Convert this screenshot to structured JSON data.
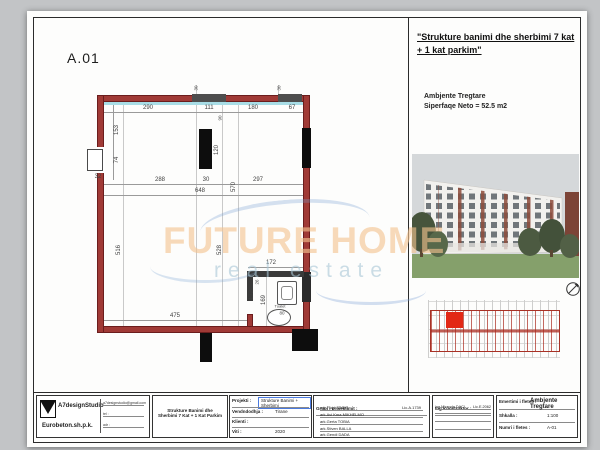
{
  "plan": {
    "label": "A.01",
    "tualet": "Tualet",
    "dims": {
      "d290": "290",
      "d111": "111",
      "d180": "180",
      "d67": "67",
      "d153": "153",
      "d74": "74",
      "d32": "32",
      "d288": "288",
      "d30": "30",
      "d297": "297",
      "d648": "648",
      "d570": "570",
      "d120": "120",
      "d90": "90",
      "d516": "516",
      "d528": "528",
      "d475": "475",
      "t172a": "172",
      "t172b": "172",
      "d169": "169",
      "d26": "26",
      "d80": "80",
      "tiny30a": "30",
      "tiny30b": "30"
    }
  },
  "watermark": {
    "line1": "FUTURE HOME",
    "line2": "real estate"
  },
  "header": {
    "title_line1": "\"Strukture banimi dhe sherbimi 7 kat",
    "title_line2": "+ 1 kat parkim\"",
    "unit": "Ambjente Tregtare",
    "area": "Siperfaqe Neto = 52.5 m2"
  },
  "titleblock": {
    "company": "A7designStudio",
    "company2": "Eurobeton.sh.p.k.",
    "contact": [
      "a7designstudio@gmail.com",
      "tel :",
      "adr :"
    ],
    "project_title_l1": "Strukture Banimi dhe",
    "project_title_l2": "Sherbimi 7 Kat + 1 Kat Parkim",
    "fields": [
      {
        "label": "Projekti :",
        "value": "Strukture Banimi + Sherbimi"
      },
      {
        "label": "Vendndodhja :",
        "value": "Tirane"
      },
      {
        "label": "Klienti :",
        "value": ""
      },
      {
        "label": "Viti :",
        "value": "2020"
      }
    ],
    "team_header": "Grupi i projektimit :",
    "team": [
      "ark.Flojd DANO",
      "ark.Avi Kma MIKHELMO",
      "ark.Gerta TOBIA",
      "ark.Stiven BALLA",
      "ark.Gendi DADA"
    ],
    "team_lic": "Lic.A.1739",
    "eng_header": "Ing.Konstruktor :",
    "eng_name": "ing.Miranda DACI",
    "eng_lic": "Lic.E.2062",
    "sheet_name_label": "Emertimi i fletes :",
    "sheet_name": "Ambjente Tregtare",
    "scale_label": "Shkalla :",
    "scale": "1:100",
    "number_label": "Numri i fletes :",
    "number": "A-01"
  },
  "colors": {
    "wall_red": "#a03a36",
    "glazing": "#a8dde6",
    "highlight": "#e22815",
    "accent_blue": "#4a7ae0"
  }
}
